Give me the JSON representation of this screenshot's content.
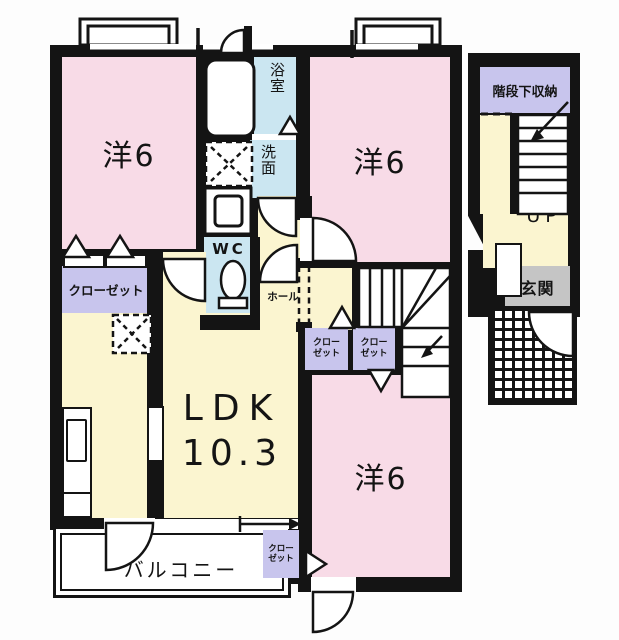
{
  "plan_title": "2LDK floor plan",
  "labels": {
    "room_tl": "洋6",
    "room_tr": "洋6",
    "room_br": "洋6",
    "ldk": "LDK",
    "ldk_size": "10.3",
    "balcony": "バルコニー",
    "closet_main": "クローゼット",
    "closet_small": {
      "line1": "クロー",
      "line2": "ゼット"
    },
    "bath": "浴室",
    "wash": "洗面",
    "wc": "WC",
    "hall": "ホール",
    "under_stair_storage": "階段下収納",
    "up": "UP",
    "entrance": "玄関"
  },
  "colors": {
    "wall": "#141414",
    "western_room_pink": "#f8dbe7",
    "floor_yellow": "#fbf5d0",
    "wet_area_blue": "#cbe6f1",
    "closet_lavender": "#c8c5ed",
    "entrance_gray": "#c5c5c5"
  }
}
